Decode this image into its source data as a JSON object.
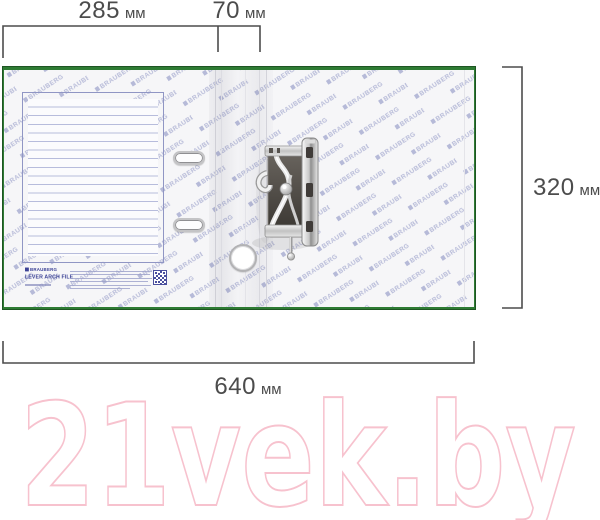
{
  "product": {
    "brand": "BRAUBERG",
    "name": "LEVER ARCH FILE",
    "pattern_watermark_text": "BRAUBERG"
  },
  "dimensions": {
    "cover_width": {
      "value": "285",
      "unit": "мм"
    },
    "spine_width": {
      "value": "70",
      "unit": "мм"
    },
    "height": {
      "value": "320",
      "unit": "мм"
    },
    "total_width": {
      "value": "640",
      "unit": "мм"
    }
  },
  "site_watermark": {
    "text": "21vek.by",
    "color": "#f7c2ce"
  },
  "colors": {
    "edge_green": "#2e7b33",
    "brand_blue": "#3c4296",
    "pattern_blue": "#a6abd0",
    "dimension_gray": "#4c4c4c"
  }
}
